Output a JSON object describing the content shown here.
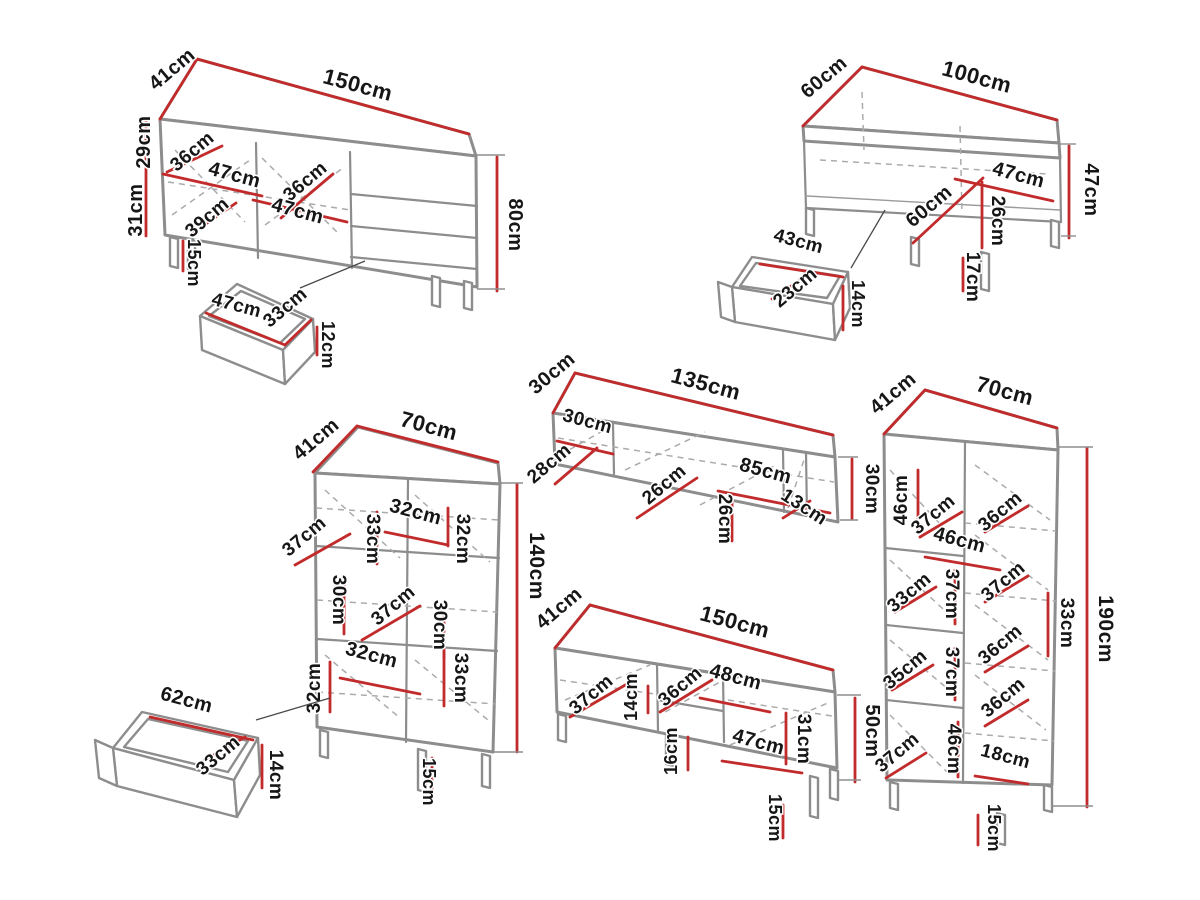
{
  "unit": "cm",
  "colors": {
    "dimension_line": "#c22b2b",
    "outline": "#8d8d8d",
    "text": "#161616"
  },
  "pieces": [
    {
      "id": "sideboard-150",
      "labels": [
        {
          "text": "41cm",
          "x": 176,
          "y": 74,
          "r": -40,
          "s": 20
        },
        {
          "text": "150cm",
          "x": 356,
          "y": 92,
          "r": 15,
          "s": 22
        },
        {
          "text": "29cm",
          "x": 150,
          "y": 142,
          "r": -90,
          "s": 20
        },
        {
          "text": "31cm",
          "x": 142,
          "y": 210,
          "r": -90,
          "s": 20
        },
        {
          "text": "15cm",
          "x": 188,
          "y": 263,
          "r": 90,
          "s": 18
        },
        {
          "text": "80cm",
          "x": 509,
          "y": 225,
          "r": 90,
          "s": 20
        },
        {
          "text": "36cm",
          "x": 196,
          "y": 156,
          "r": -40,
          "s": 19
        },
        {
          "text": "47cm",
          "x": 233,
          "y": 181,
          "r": 15,
          "s": 20
        },
        {
          "text": "36cm",
          "x": 309,
          "y": 186,
          "r": -40,
          "s": 19
        },
        {
          "text": "47cm",
          "x": 296,
          "y": 217,
          "r": 15,
          "s": 20
        },
        {
          "text": "39cm",
          "x": 211,
          "y": 222,
          "r": -40,
          "s": 19
        }
      ]
    },
    {
      "id": "sideboard-drawer",
      "labels": [
        {
          "text": "47cm",
          "x": 235,
          "y": 311,
          "r": 15,
          "s": 19
        },
        {
          "text": "33cm",
          "x": 289,
          "y": 312,
          "r": -40,
          "s": 19
        },
        {
          "text": "12cm",
          "x": 322,
          "y": 345,
          "r": 90,
          "s": 18
        }
      ]
    },
    {
      "id": "coffee-table-100",
      "labels": [
        {
          "text": "60cm",
          "x": 828,
          "y": 82,
          "r": -40,
          "s": 20
        },
        {
          "text": "100cm",
          "x": 975,
          "y": 84,
          "r": 15,
          "s": 22
        },
        {
          "text": "47cm",
          "x": 1085,
          "y": 190,
          "r": 90,
          "s": 20
        },
        {
          "text": "47cm",
          "x": 1017,
          "y": 181,
          "r": 15,
          "s": 20
        },
        {
          "text": "60cm",
          "x": 933,
          "y": 211,
          "r": -40,
          "s": 20
        },
        {
          "text": "26cm",
          "x": 992,
          "y": 221,
          "r": 90,
          "s": 19
        },
        {
          "text": "17cm",
          "x": 967,
          "y": 277,
          "r": 90,
          "s": 19
        }
      ]
    },
    {
      "id": "coffee-table-drawer",
      "labels": [
        {
          "text": "43cm",
          "x": 797,
          "y": 247,
          "r": 15,
          "s": 19
        },
        {
          "text": "23cm",
          "x": 799,
          "y": 292,
          "r": -40,
          "s": 19
        },
        {
          "text": "14cm",
          "x": 852,
          "y": 304,
          "r": 90,
          "s": 18
        }
      ]
    },
    {
      "id": "wall-shelf-135",
      "labels": [
        {
          "text": "30cm",
          "x": 556,
          "y": 378,
          "r": -40,
          "s": 20
        },
        {
          "text": "135cm",
          "x": 704,
          "y": 391,
          "r": 15,
          "s": 22
        },
        {
          "text": "30cm",
          "x": 586,
          "y": 427,
          "r": 15,
          "s": 19
        },
        {
          "text": "28cm",
          "x": 553,
          "y": 468,
          "r": -40,
          "s": 19
        },
        {
          "text": "26cm",
          "x": 668,
          "y": 489,
          "r": -40,
          "s": 19
        },
        {
          "text": "85cm",
          "x": 764,
          "y": 477,
          "r": 15,
          "s": 20
        },
        {
          "text": "26cm",
          "x": 719,
          "y": 519,
          "r": 90,
          "s": 19
        },
        {
          "text": "13cm",
          "x": 801,
          "y": 512,
          "r": 33,
          "s": 19
        },
        {
          "text": "30cm",
          "x": 866,
          "y": 489,
          "r": 90,
          "s": 19
        }
      ]
    },
    {
      "id": "display-cabinet-140",
      "labels": [
        {
          "text": "41cm",
          "x": 320,
          "y": 444,
          "r": -40,
          "s": 20
        },
        {
          "text": "70cm",
          "x": 427,
          "y": 433,
          "r": 15,
          "s": 22
        },
        {
          "text": "140cm",
          "x": 530,
          "y": 566,
          "r": 90,
          "s": 21
        },
        {
          "text": "37cm",
          "x": 308,
          "y": 541,
          "r": -40,
          "s": 19
        },
        {
          "text": "33cm",
          "x": 367,
          "y": 539,
          "r": 90,
          "s": 19
        },
        {
          "text": "32cm",
          "x": 414,
          "y": 518,
          "r": 15,
          "s": 20
        },
        {
          "text": "32cm",
          "x": 457,
          "y": 539,
          "r": 90,
          "s": 19
        },
        {
          "text": "30cm",
          "x": 333,
          "y": 600,
          "r": 90,
          "s": 19
        },
        {
          "text": "37cm",
          "x": 397,
          "y": 610,
          "r": -40,
          "s": 19
        },
        {
          "text": "30cm",
          "x": 434,
          "y": 625,
          "r": 90,
          "s": 19
        },
        {
          "text": "32cm",
          "x": 370,
          "y": 661,
          "r": 15,
          "s": 20
        },
        {
          "text": "32cm",
          "x": 320,
          "y": 688,
          "r": -90,
          "s": 19
        },
        {
          "text": "33cm",
          "x": 455,
          "y": 678,
          "r": 90,
          "s": 19
        },
        {
          "text": "15cm",
          "x": 423,
          "y": 782,
          "r": 90,
          "s": 18
        }
      ]
    },
    {
      "id": "cabinet-drawer",
      "labels": [
        {
          "text": "62cm",
          "x": 185,
          "y": 706,
          "r": 15,
          "s": 20
        },
        {
          "text": "33cm",
          "x": 222,
          "y": 760,
          "r": -40,
          "s": 19
        },
        {
          "text": "14cm",
          "x": 270,
          "y": 775,
          "r": 90,
          "s": 19
        }
      ]
    },
    {
      "id": "tv-stand-150",
      "labels": [
        {
          "text": "41cm",
          "x": 563,
          "y": 613,
          "r": -40,
          "s": 20
        },
        {
          "text": "150cm",
          "x": 733,
          "y": 629,
          "r": 15,
          "s": 22
        },
        {
          "text": "50cm",
          "x": 866,
          "y": 731,
          "r": 90,
          "s": 20
        },
        {
          "text": "37cm",
          "x": 595,
          "y": 699,
          "r": -40,
          "s": 19
        },
        {
          "text": "14cm",
          "x": 637,
          "y": 697,
          "r": -90,
          "s": 18
        },
        {
          "text": "36cm",
          "x": 684,
          "y": 691,
          "r": -40,
          "s": 19
        },
        {
          "text": "48cm",
          "x": 734,
          "y": 683,
          "r": 15,
          "s": 20
        },
        {
          "text": "16cm",
          "x": 677,
          "y": 751,
          "r": -90,
          "s": 18
        },
        {
          "text": "47cm",
          "x": 757,
          "y": 748,
          "r": 15,
          "s": 20
        },
        {
          "text": "31cm",
          "x": 798,
          "y": 739,
          "r": 90,
          "s": 19
        },
        {
          "text": "15cm",
          "x": 769,
          "y": 818,
          "r": 90,
          "s": 18
        }
      ]
    },
    {
      "id": "tall-cabinet-190",
      "labels": [
        {
          "text": "41cm",
          "x": 897,
          "y": 398,
          "r": -40,
          "s": 20
        },
        {
          "text": "70cm",
          "x": 1003,
          "y": 398,
          "r": 15,
          "s": 22
        },
        {
          "text": "190cm",
          "x": 1099,
          "y": 629,
          "r": 90,
          "s": 21
        },
        {
          "text": "46cm",
          "x": 907,
          "y": 500,
          "r": -90,
          "s": 19
        },
        {
          "text": "37cm",
          "x": 937,
          "y": 519,
          "r": -40,
          "s": 19
        },
        {
          "text": "36cm",
          "x": 1004,
          "y": 516,
          "r": -40,
          "s": 19
        },
        {
          "text": "46cm",
          "x": 958,
          "y": 546,
          "r": 15,
          "s": 20
        },
        {
          "text": "33cm",
          "x": 913,
          "y": 597,
          "r": -40,
          "s": 19
        },
        {
          "text": "37cm",
          "x": 946,
          "y": 594,
          "r": 90,
          "s": 19
        },
        {
          "text": "37cm",
          "x": 1007,
          "y": 586,
          "r": -40,
          "s": 19
        },
        {
          "text": "33cm",
          "x": 1061,
          "y": 623,
          "r": 90,
          "s": 19
        },
        {
          "text": "35cm",
          "x": 909,
          "y": 674,
          "r": -40,
          "s": 19
        },
        {
          "text": "37cm",
          "x": 946,
          "y": 672,
          "r": 90,
          "s": 19
        },
        {
          "text": "36cm",
          "x": 1004,
          "y": 649,
          "r": -40,
          "s": 19
        },
        {
          "text": "37cm",
          "x": 901,
          "y": 757,
          "r": -40,
          "s": 19
        },
        {
          "text": "46cm",
          "x": 948,
          "y": 749,
          "r": 90,
          "s": 19
        },
        {
          "text": "36cm",
          "x": 1007,
          "y": 702,
          "r": -40,
          "s": 19
        },
        {
          "text": "18cm",
          "x": 1004,
          "y": 762,
          "r": 15,
          "s": 19
        },
        {
          "text": "15cm",
          "x": 988,
          "y": 828,
          "r": 90,
          "s": 18
        }
      ]
    }
  ]
}
